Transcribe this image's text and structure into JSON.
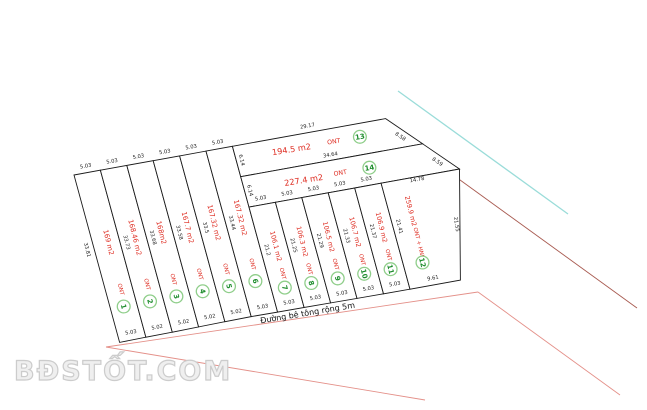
{
  "watermark": "BĐSTỐT.COM",
  "road_label": "Đường bê tông rộng 5m",
  "plots": [
    {
      "no": "1",
      "area": "169 m2",
      "use": "ONT",
      "top": "5.03",
      "bottom": "5.03",
      "left": "33.81"
    },
    {
      "no": "2",
      "area": "168.46 m2",
      "use": "ONT",
      "top": "5.03",
      "bottom": "5.02",
      "left": "33.73"
    },
    {
      "no": "3",
      "area": "168m2",
      "use": "ONT",
      "top": "5.03",
      "bottom": "5.02",
      "left": "33.68"
    },
    {
      "no": "4",
      "area": "167.7 m2",
      "use": "ONT",
      "top": "5.03",
      "bottom": "5.02",
      "left": "33.58"
    },
    {
      "no": "5",
      "area": "167.32 m2",
      "use": "ONT",
      "top": "5.03",
      "bottom": "5.02",
      "left": "33.5"
    },
    {
      "no": "6",
      "area": "167.32 m2",
      "use": "ONT",
      "top": "5.03",
      "bottom": "5.03",
      "left": "33.44"
    },
    {
      "no": "7",
      "area": "106.1 m2",
      "use": "ONT",
      "top": "5.03",
      "bottom": "5.03",
      "left": "21.2"
    },
    {
      "no": "8",
      "area": "106.3 m2",
      "use": "ONT",
      "top": "5.03",
      "bottom": "5.03",
      "left": "21.25"
    },
    {
      "no": "9",
      "area": "106.5 m2",
      "use": "ONT",
      "top": "5.03",
      "bottom": "5.03",
      "left": "21.29"
    },
    {
      "no": "10",
      "area": "106.7 m2",
      "use": "ONT",
      "top": "5.03",
      "bottom": "5.03",
      "left": "21.33"
    },
    {
      "no": "11",
      "area": "106.9 m2",
      "use": "ONT",
      "top": "5.03",
      "bottom": "5.03",
      "left": "21.37"
    },
    {
      "no": "12",
      "area": "259.9 m2",
      "use": "ONT + HNK",
      "top": "14.78",
      "bottom": "9.61",
      "left": "21.41",
      "right": "21.55"
    },
    {
      "no": "13",
      "area": "194.5 m2",
      "use": "ONT",
      "top": "29.17",
      "bottom": "34.64",
      "left": "6.14",
      "right": "8.58"
    },
    {
      "no": "14",
      "area": "227.4 m2",
      "use": "ONT",
      "top": "34.64",
      "left": "6.14",
      "right": "8.59"
    }
  ],
  "colors": {
    "parcel_outline": "#1a1a1a",
    "area_label_red": "#de2a1f",
    "edge_label": "#222222",
    "badge_number_green": "#1d8c2c",
    "badge_ring_green": "#8fce8a",
    "boundary_red_dark": "#a85a50",
    "boundary_red_light": "#e49089",
    "utility_line_cyan": "#9adcd9",
    "watermark_gray": "#e9e9e9"
  }
}
